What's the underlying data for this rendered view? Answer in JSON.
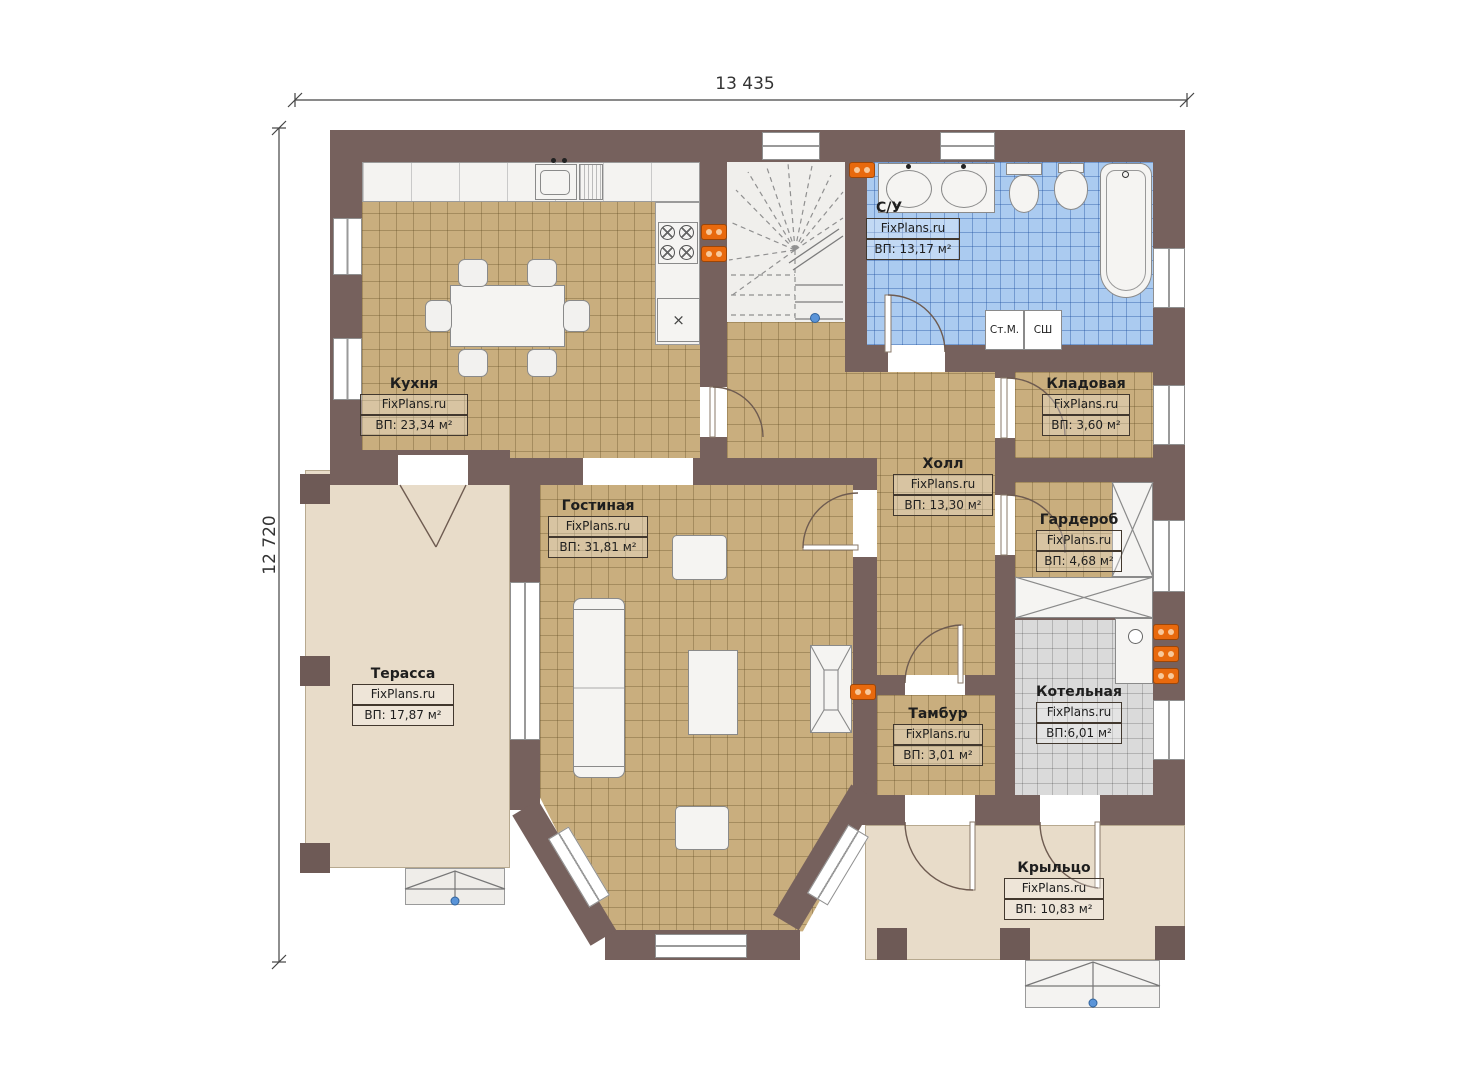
{
  "dimensions": {
    "width_label": "13 435",
    "height_label": "12 720"
  },
  "rooms": [
    {
      "id": "kitchen",
      "name": "Кухня",
      "site": "FixPlans.ru",
      "area": "ВП: 23,34 м²"
    },
    {
      "id": "bathroom",
      "name": "С/У",
      "site": "FixPlans.ru",
      "area": "ВП: 13,17 м²"
    },
    {
      "id": "storage",
      "name": "Кладовая",
      "site": "FixPlans.ru",
      "area": "ВП: 3,60 м²"
    },
    {
      "id": "hall",
      "name": "Холл",
      "site": "FixPlans.ru",
      "area": "ВП: 13,30 м²"
    },
    {
      "id": "wardrobe",
      "name": "Гардероб",
      "site": "FixPlans.ru",
      "area": "ВП: 4,68 м²"
    },
    {
      "id": "living",
      "name": "Гостиная",
      "site": "FixPlans.ru",
      "area": "ВП: 31,81 м²"
    },
    {
      "id": "terrace",
      "name": "Терасса",
      "site": "FixPlans.ru",
      "area": "ВП: 17,87 м²"
    },
    {
      "id": "vestibule",
      "name": "Тамбур",
      "site": "FixPlans.ru",
      "area": "ВП: 3,01 м²"
    },
    {
      "id": "boiler",
      "name": "Котельная",
      "site": "FixPlans.ru",
      "area": "ВП:6,01 м²"
    },
    {
      "id": "porch",
      "name": "Крыльцо",
      "site": "FixPlans.ru",
      "area": "ВП: 10,83 м²"
    }
  ],
  "appliances": {
    "washing_machine": "Ст.М.",
    "dryer": "СШ"
  },
  "colors": {
    "wall": "#76615d",
    "floor_tile_tan": "#c9ae7e",
    "floor_tile_blue": "#abcbf0",
    "floor_gray": "#dadada",
    "floor_beige": "#e8dcc9",
    "radiator_orange": "#e8690d",
    "marker_blue": "#5a94d8"
  }
}
